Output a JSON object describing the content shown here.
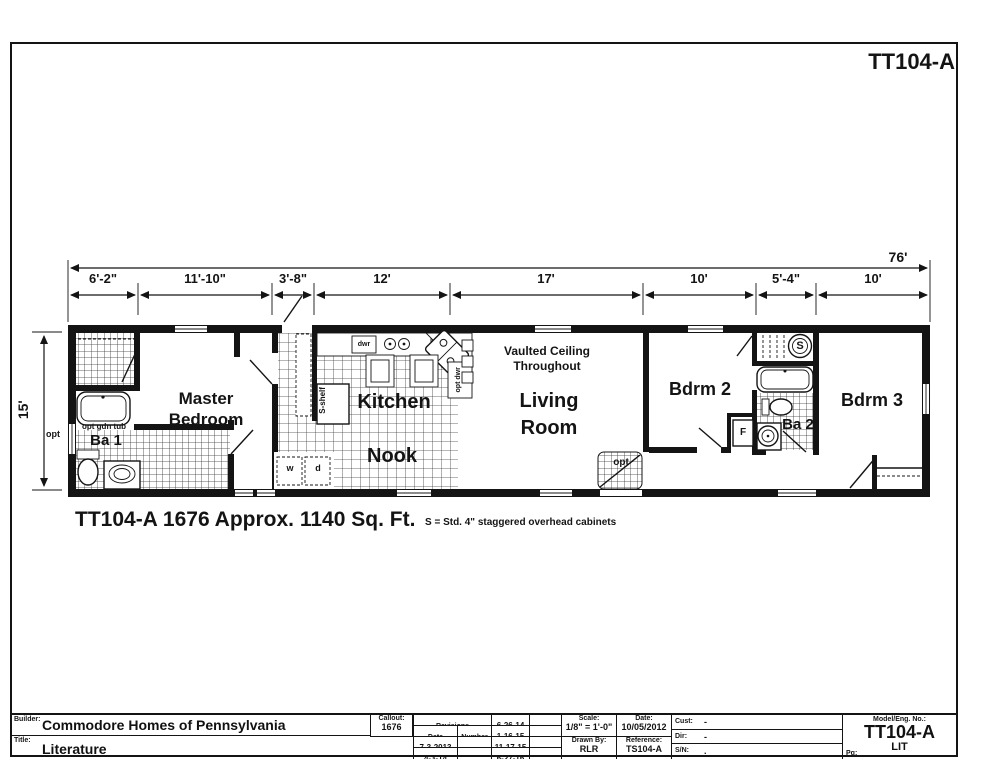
{
  "page": {
    "sheet_code": "TT104-A",
    "plan_caption": "TT104-A 1676  Approx. 1140 Sq. Ft.",
    "cabinet_note": "S = Std. 4\" staggered overhead cabinets"
  },
  "dimensions": {
    "overall_width": "76'",
    "overall_depth": "15'",
    "segments": [
      "6'-2\"",
      "11'-10\"",
      "3'-8\"",
      "12'",
      "17'",
      "10'",
      "5'-4\"",
      "10'"
    ]
  },
  "rooms": {
    "master_bedroom": "Master Bedroom",
    "ba1": "Ba 1",
    "kitchen": "Kitchen",
    "nook": "Nook",
    "living_room": "Living Room",
    "vaulted_note": "Vaulted Ceiling Throughout",
    "bdrm2": "Bdrm 2",
    "ba2": "Ba 2",
    "bdrm3": "Bdrm 3"
  },
  "annotations": {
    "opt_window": "opt",
    "opt_gdn_tub": "opt gdn tub",
    "s_shelf": "S-shelf",
    "dwr": "dwr",
    "opt_dwr": "opt dwr",
    "washer": "w",
    "dryer": "d",
    "furnace": "F",
    "water_heater": "S",
    "opt_rear_door": "opt"
  },
  "title_block": {
    "builder_label": "Builder:",
    "builder": "Commodore Homes of Pennsylvania",
    "title_label": "Title:",
    "title": "Literature",
    "callout_label": "Callout:",
    "callout": "1676",
    "revisions_label": "Revisions",
    "date_col": "Date",
    "number_col": "Number",
    "rev_col1": [
      {
        "date": "7-3-2013",
        "number": "."
      },
      {
        "date": "4-3-14",
        "number": "."
      }
    ],
    "rev_col2": [
      {
        "date": "6-26-14",
        "number": "."
      },
      {
        "date": "1-16-15",
        "number": "."
      },
      {
        "date": "11-17-15",
        "number": "."
      },
      {
        "date": "6-27-16",
        "number": "."
      }
    ],
    "scale_label": "Scale:",
    "scale": "1/8\" = 1'-0\"",
    "date_label": "Date:",
    "date": "10/05/2012",
    "drawn_by_label": "Drawn By:",
    "drawn_by": "RLR",
    "reference_label": "Reference:",
    "reference": "TS104-A",
    "cust_label": "Cust:",
    "cust": "-",
    "dir_label": "Dir:",
    "dir": "-",
    "sn_label": "S/N:",
    "sn": ".",
    "model_label": "Model/Eng. No.:",
    "model": "TT104-A",
    "pg_label": "Pg:",
    "pg": "LIT"
  }
}
